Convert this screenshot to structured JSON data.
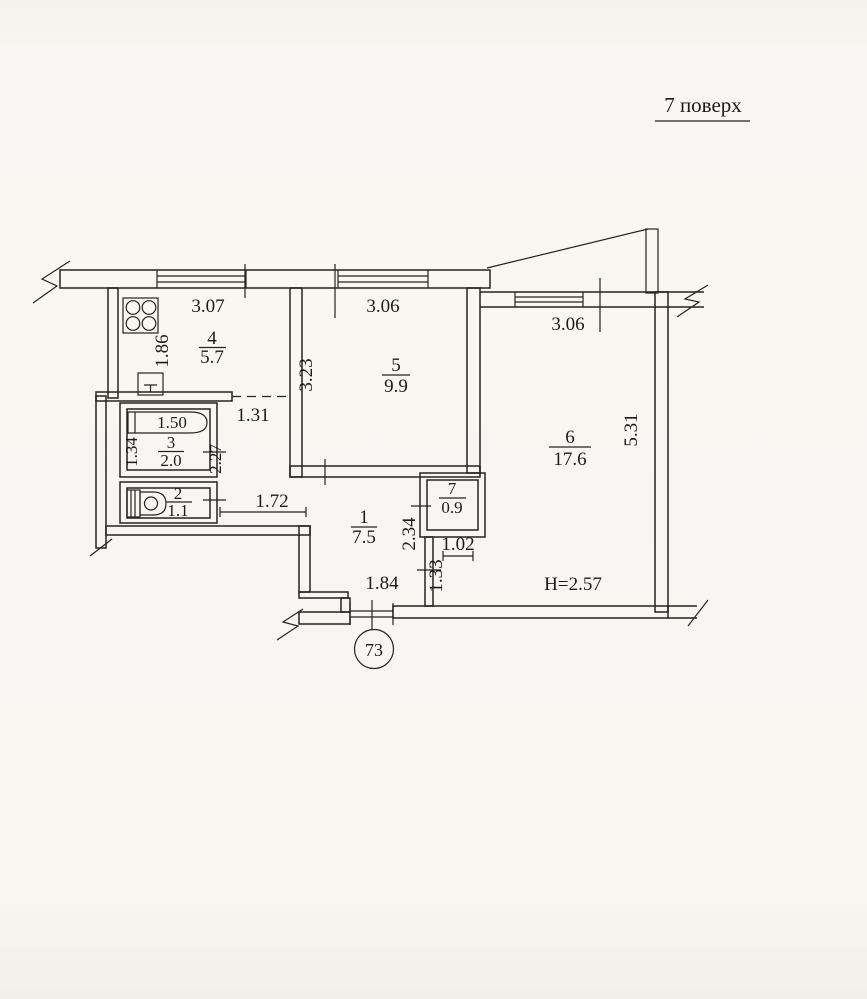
{
  "title": {
    "floor_label": "7 поверх"
  },
  "apartment": {
    "number": "73",
    "ceiling_height": "H=2.57"
  },
  "rooms": {
    "r1": {
      "number": "1",
      "area": "7.5"
    },
    "r2": {
      "number": "2",
      "area": "1.1"
    },
    "r3": {
      "number": "3",
      "area": "2.0"
    },
    "r4": {
      "number": "4",
      "area": "5.7"
    },
    "r5": {
      "number": "5",
      "area": "9.9"
    },
    "r6": {
      "number": "6",
      "area": "17.6"
    },
    "r7": {
      "number": "7",
      "area": "0.9"
    }
  },
  "dimensions": {
    "kitchen_window_width": "3.07",
    "room5_window_width": "3.06",
    "room6_window_width": "3.06",
    "kitchen_depth": "1.86",
    "room5_depth": "3.23",
    "kitchen_niche_width": "1.31",
    "bathroom_depth": "2.27",
    "bathroom_width": "1.34",
    "bathtub_length": "1.50",
    "corridor_width": "1.72",
    "hall_right_upper": "2.34",
    "room6_passage_width": "1.02",
    "hall_right_lower": "1.33",
    "entrance_width": "1.84",
    "room6_depth": "5.31"
  }
}
